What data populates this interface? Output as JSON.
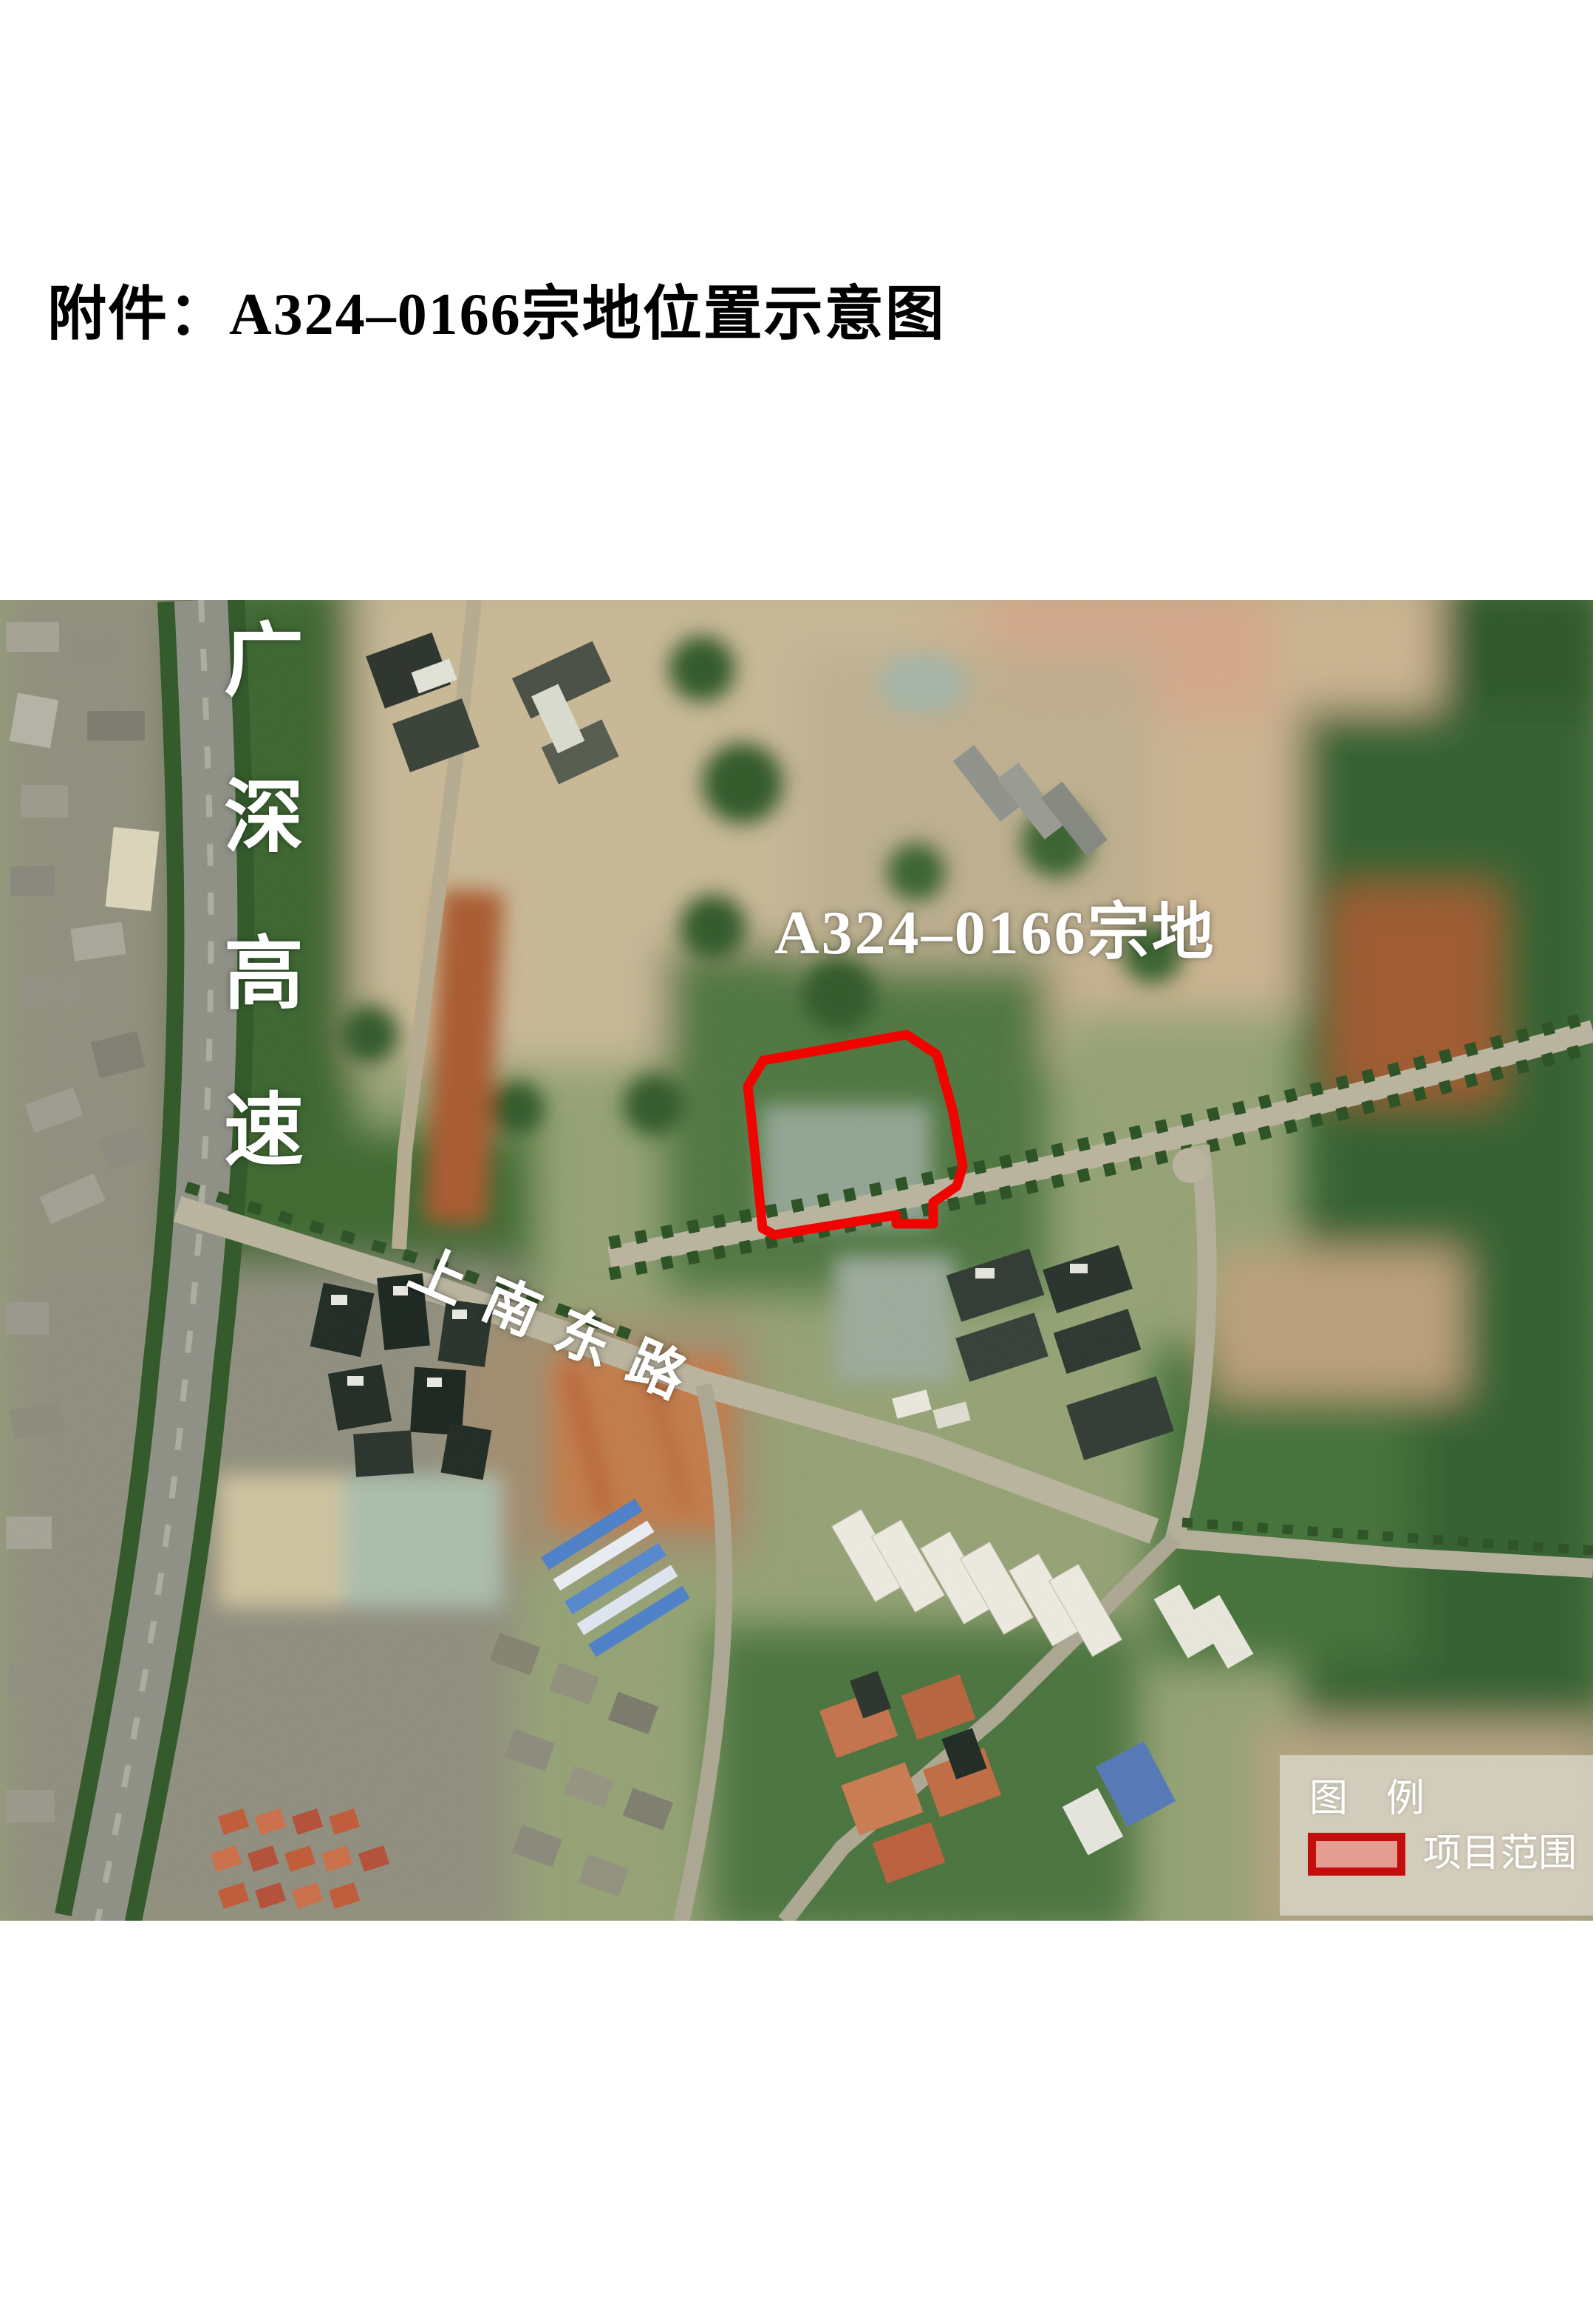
{
  "page": {
    "title": "附件：A324–0166宗地位置示意图"
  },
  "map": {
    "labels": {
      "expressway": "广深高速",
      "parcel": "A324–0166宗地",
      "road": "上南东路"
    },
    "legend": {
      "title": "图　例",
      "item": "项目范围"
    },
    "colors": {
      "parcel_outline": "#f00400",
      "legend_swatch_border": "#c50d0d",
      "legend_swatch_fill": "#e7948a",
      "label_text": "#ffffff"
    }
  }
}
